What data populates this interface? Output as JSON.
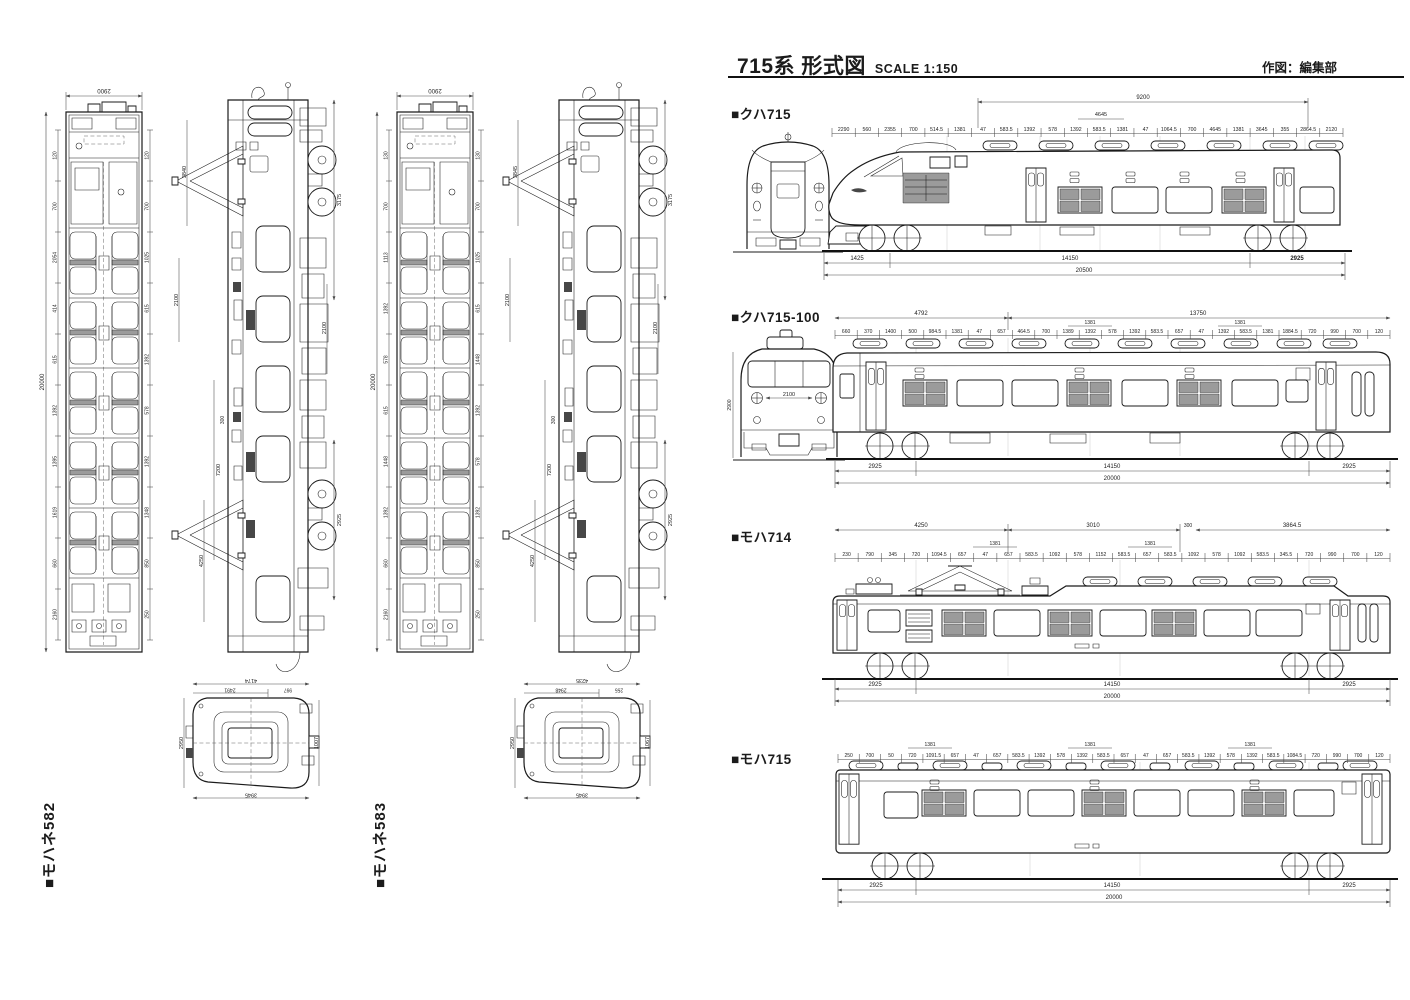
{
  "header": {
    "title": "715系 形式図",
    "scale": "SCALE 1:150",
    "credit": "作図：編集部"
  },
  "left": {
    "cars": [
      {
        "label": "■モハネ582",
        "width_dim": "2900",
        "length_dim": "20000",
        "plan_left_dims": [
          "120",
          "700",
          "2054",
          "414",
          "615",
          "1392",
          "1395",
          "1619",
          "660",
          "2160"
        ],
        "plan_right_dims": [
          "120",
          "700",
          "1025",
          "615",
          "1392",
          "578",
          "1392",
          "1348",
          "850",
          "250"
        ],
        "side_dims": [
          "3175",
          "2100",
          "2925",
          "7200",
          "4250",
          "300",
          "2100",
          "3840"
        ],
        "cross_dims": {
          "top": "4174",
          "upper_left": "2491",
          "upper_right": "997",
          "left": "2950",
          "bottom": "3945",
          "right": "1007"
        }
      },
      {
        "label": "■モハネ583",
        "width_dim": "2900",
        "length_dim": "20000",
        "plan_left_dims": [
          "130",
          "700",
          "1113",
          "1392",
          "578",
          "615",
          "1448",
          "1392",
          "660",
          "2160"
        ],
        "plan_right_dims": [
          "130",
          "700",
          "1025",
          "615",
          "1448",
          "1392",
          "578",
          "1392",
          "850",
          "250"
        ],
        "side_dims": [
          "3175",
          "2100",
          "2925",
          "7200",
          "4250",
          "300",
          "2100",
          "3845"
        ],
        "cross_dims": {
          "top": "4235",
          "upper_left": "2948",
          "upper_right": "255",
          "left": "2950",
          "bottom": "3945",
          "right": "1067"
        }
      }
    ]
  },
  "right": {
    "cars": [
      {
        "label": "■クハ715",
        "span_dims": [
          "9200",
          "4645"
        ],
        "top_dims": [
          "2290",
          "560",
          "2355",
          "700",
          "514.5",
          "1381",
          "47",
          "583.5",
          "1392",
          "578",
          "1392",
          "583.5",
          "1381",
          "47",
          "1064.5",
          "700",
          "4645",
          "1381",
          "3645",
          "355",
          "2864.5",
          "2120"
        ],
        "bottom_dims": [
          "1425",
          "14150",
          "2925"
        ],
        "total_dim": "20500"
      },
      {
        "label": "■クハ715-100",
        "span_dims": [
          "4792",
          "13750"
        ],
        "group_dim": "1381",
        "front_width": "2100",
        "front_height": "2900",
        "top_dims": [
          "660",
          "370",
          "1400",
          "500",
          "984.5",
          "1381",
          "47",
          "657",
          "464.5",
          "700",
          "1389",
          "1392",
          "578",
          "1392",
          "583.5",
          "657",
          "47",
          "1392",
          "583.5",
          "1381",
          "1884.5",
          "720",
          "990",
          "700",
          "120"
        ],
        "bottom_dims": [
          "2925",
          "14150",
          "2925"
        ],
        "total_dim": "20000"
      },
      {
        "label": "■モハ714",
        "span_dims": [
          "4250",
          "3010",
          "300",
          "3864.5"
        ],
        "group_dim": "1381",
        "top_dims": [
          "230",
          "790",
          "345",
          "720",
          "1094.5",
          "657",
          "47",
          "657",
          "583.5",
          "1092",
          "578",
          "1152",
          "583.5",
          "657",
          "583.5",
          "1092",
          "578",
          "1092",
          "583.5",
          "345.5",
          "720",
          "990",
          "700",
          "120"
        ],
        "bottom_dims": [
          "2925",
          "14150",
          "2925"
        ],
        "total_dim": "20000"
      },
      {
        "label": "■モハ715",
        "span_dims": [],
        "group_dim": "1381",
        "top_dims": [
          "250",
          "700",
          "50",
          "720",
          "1091.5",
          "657",
          "47",
          "657",
          "583.5",
          "1392",
          "578",
          "1392",
          "583.5",
          "657",
          "47",
          "657",
          "583.5",
          "1392",
          "578",
          "1392",
          "583.5",
          "1084.5",
          "720",
          "990",
          "700",
          "120"
        ],
        "bottom_dims": [
          "2925",
          "14150",
          "2925"
        ],
        "total_dim": "20000"
      }
    ]
  }
}
